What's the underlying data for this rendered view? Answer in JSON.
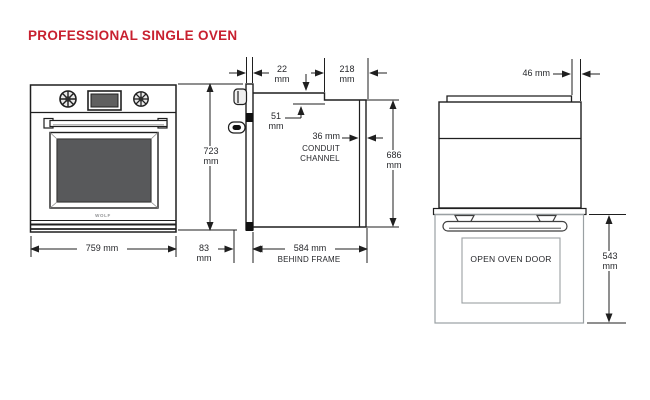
{
  "title": "PROFESSIONAL SINGLE OVEN",
  "brand_logo": "WOLF",
  "colors": {
    "title_red": "#c8202f",
    "glass_gray": "#58595b",
    "door_outline_gray": "#9aa0a3",
    "line_black": "#1f1f1f"
  },
  "views": {
    "front": "oven front elevation",
    "side": "oven side section",
    "door_open": "oven side with door open"
  },
  "dims": {
    "d759": {
      "value": "759 mm"
    },
    "d723": {
      "value": "723",
      "unit": "mm"
    },
    "d83": {
      "value": "83",
      "unit": "mm"
    },
    "d584": {
      "value": "584 mm",
      "label": "BEHIND FRAME"
    },
    "d22": {
      "value": "22",
      "unit": "mm"
    },
    "d218": {
      "value": "218",
      "unit": "mm"
    },
    "d51": {
      "value": "51",
      "unit": "mm"
    },
    "d36": {
      "value": "36 mm",
      "label_line1": "CONDUIT",
      "label_line2": "CHANNEL"
    },
    "d686": {
      "value": "686",
      "unit": "mm"
    },
    "d46": {
      "value": "46 mm"
    },
    "d543": {
      "value": "543",
      "unit": "mm"
    }
  },
  "open_door": {
    "label": "OPEN OVEN DOOR"
  }
}
